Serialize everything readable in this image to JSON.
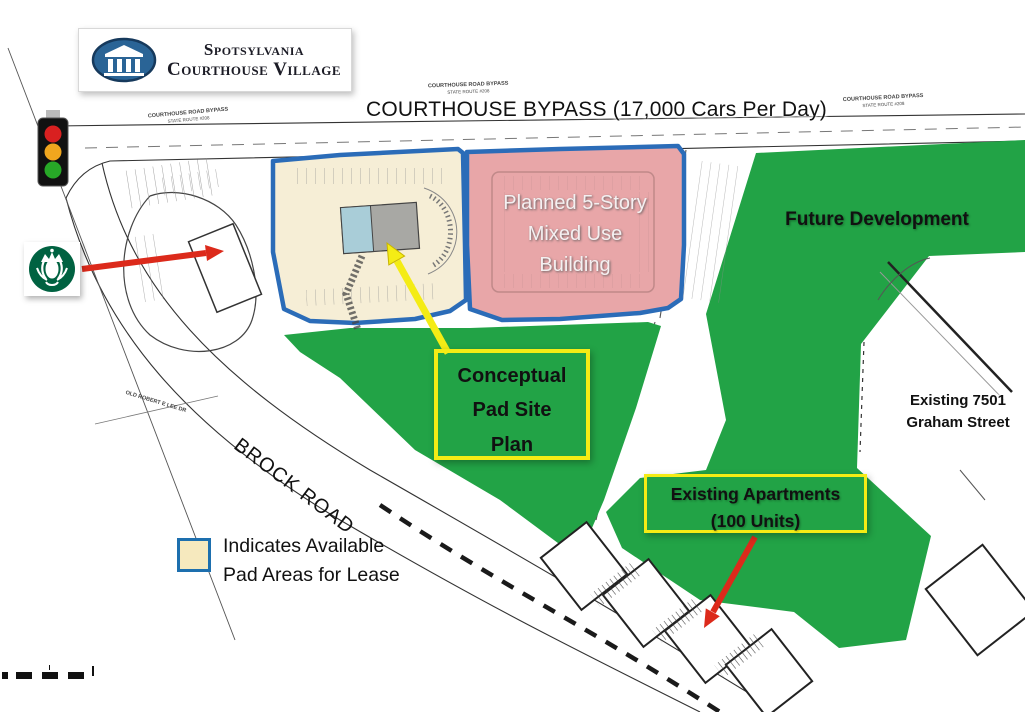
{
  "branding": {
    "logo": {
      "line1": "Spotsylvania",
      "line2": "Courthouse Village",
      "icon": "courthouse-columns-emblem"
    }
  },
  "roads": {
    "bypass_banner": "COURTHOUSE BYPASS (17,000 Cars Per Day)",
    "brock_road": "BROCK ROAD",
    "bypass_small": {
      "line1": "COURTHOUSE ROAD BYPASS",
      "line2": "STATE ROUTE #208"
    },
    "old_lee_dr": "OLD ROBERT E LEE DR"
  },
  "areas": {
    "pad_site": {
      "fill": "#F6EED6",
      "outline": "#2B6CB8"
    },
    "mixed_use": {
      "line1": "Planned 5-Story",
      "line2": "Mixed Use",
      "line3": "Building",
      "fill": "#E8A6A8"
    },
    "future_development": {
      "label": "Future Development",
      "fill": "#22A346"
    }
  },
  "callouts": {
    "conceptual": {
      "line1": "Conceptual",
      "line2": "Pad Site",
      "line3": "Plan",
      "border": "#F4EC15"
    },
    "apartments": {
      "line1": "Existing Apartments",
      "line2": "(100 Units)",
      "border": "#F4EC15"
    },
    "graham": {
      "line1": "Existing 7501",
      "line2": "Graham Street"
    }
  },
  "legend": {
    "line1": "Indicates Available",
    "line2": "Pad Areas for Lease",
    "swatch_fill": "#F6E9BE",
    "swatch_border": "#1D6FAE"
  },
  "icons": {
    "traffic_light": "traffic-light-icon",
    "starbucks": "starbucks-logo-icon",
    "courthouse": "courthouse-logo-icon",
    "scale_bar": "map-scale-bar"
  },
  "colors": {
    "arrow_red": "#DC2A1B",
    "arrow_yellow": "#F4EC15",
    "plan_line": "#333333",
    "traffic_red": "#D92020",
    "traffic_amber": "#F0A61E",
    "traffic_green": "#27A827"
  }
}
